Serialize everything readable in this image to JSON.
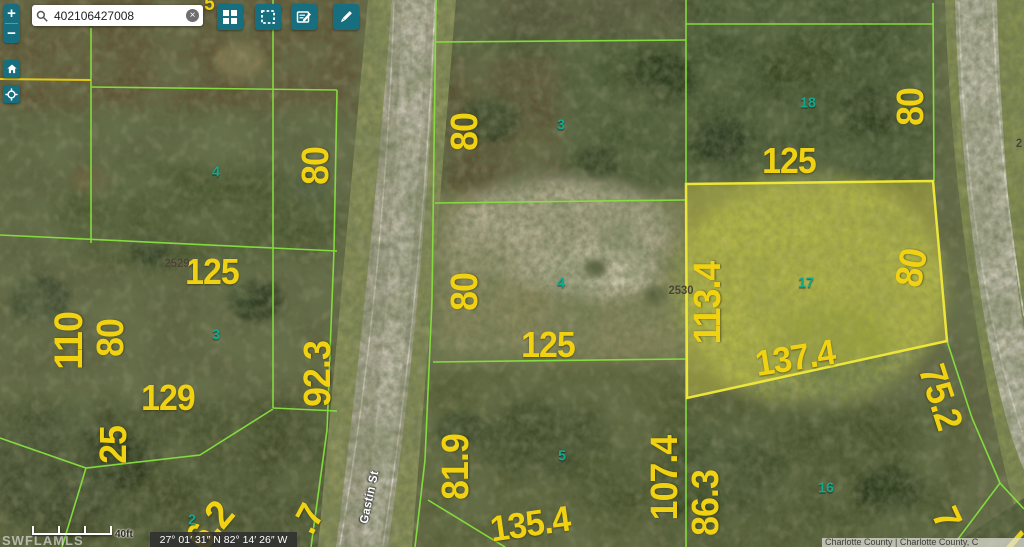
{
  "zoom_controls": {
    "zoom_in": "+",
    "zoom_out": "−"
  },
  "search": {
    "value": "402106427008",
    "clear_glyph": "×"
  },
  "map": {
    "street_labels": [
      "Gastin St"
    ],
    "dimension_labels": [
      "80",
      "125",
      "110",
      "80",
      "92.3",
      "129",
      "25",
      "6.2",
      ".7",
      "80",
      "80",
      "125",
      "81.9",
      "135.4",
      "107.4",
      "86.3",
      "80",
      "125",
      "113.4",
      "80",
      "137.4",
      "75.2",
      "7",
      "5"
    ],
    "lot_numbers": [
      "4",
      "3",
      "2",
      "3",
      "4",
      "5",
      "18",
      "17",
      "16"
    ],
    "parcel_ids": [
      "2529",
      "2530",
      "2"
    ],
    "colors": {
      "parcel_line": "#86e03e",
      "highlight_line": "#ece53a",
      "dimension_text": "#f0d213",
      "lot_text": "#14a88f",
      "ui_teal": "#176e7e"
    }
  },
  "status_bar": {
    "scale_label": "40ft",
    "coordinates": "27° 01′ 31″ N 82° 14′ 26″ W",
    "watermark": "SWFLAMLS",
    "attribution": "Charlotte County | Charlotte County, C"
  }
}
